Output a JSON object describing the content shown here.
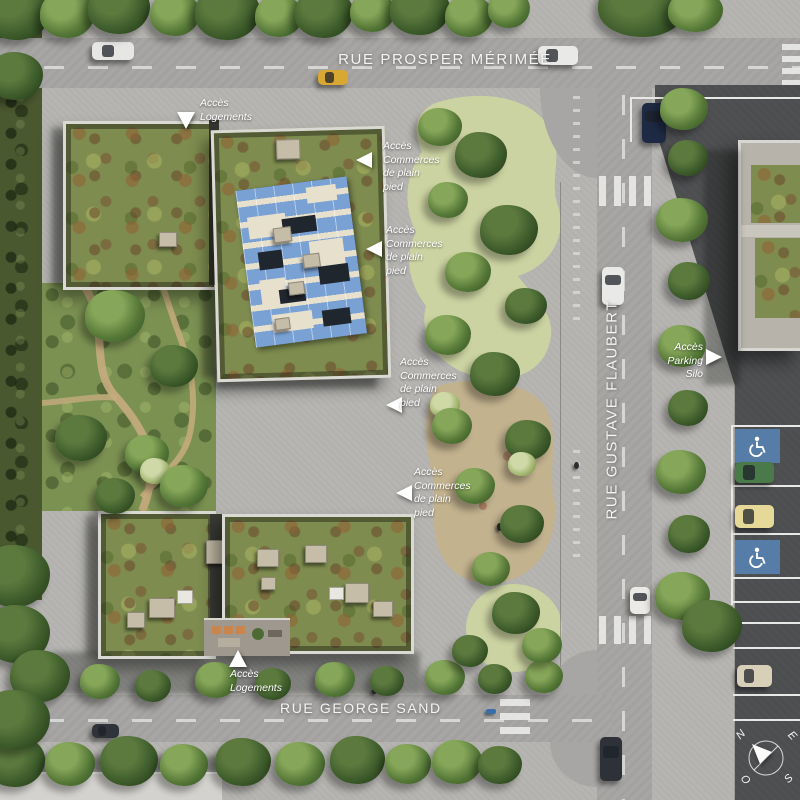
{
  "scene_title": "Plan masse aérien du quartier",
  "streets": {
    "prosper_merimee": "RUE PROSPER MÉRIMÉE",
    "gustave_flaubert": "RUE GUSTAVE FLAUBERT",
    "george_sand": "RUE GEORGE SAND"
  },
  "annotations": {
    "acces_logements_nord": "Accès\nLogements",
    "acces_commerces_1": "Accès\nCommerces\nde plain\npied",
    "acces_commerces_2": "Accès\nCommerces\nde plain\npied",
    "acces_commerces_3": "Accès\nCommerces\nde plain\npied",
    "acces_commerces_4": "Accès\nCommerces\nde plain\npied",
    "acces_parking_silo": "Accès\nParking Silo",
    "acces_logements_sud": "Accès\nLogements"
  },
  "compass": {
    "north": "N",
    "east": "E",
    "south": "S",
    "west": "O"
  },
  "colors": {
    "road": "#a7a6a4",
    "sidewalk": "#b6b5b2",
    "dark_asphalt": "#4d4e50",
    "sedum_roof": "#7e8c4f",
    "solar_panel_blue": "#79a1d4",
    "handicap_blue": "#567ca8",
    "label_white": "#ffffff"
  }
}
